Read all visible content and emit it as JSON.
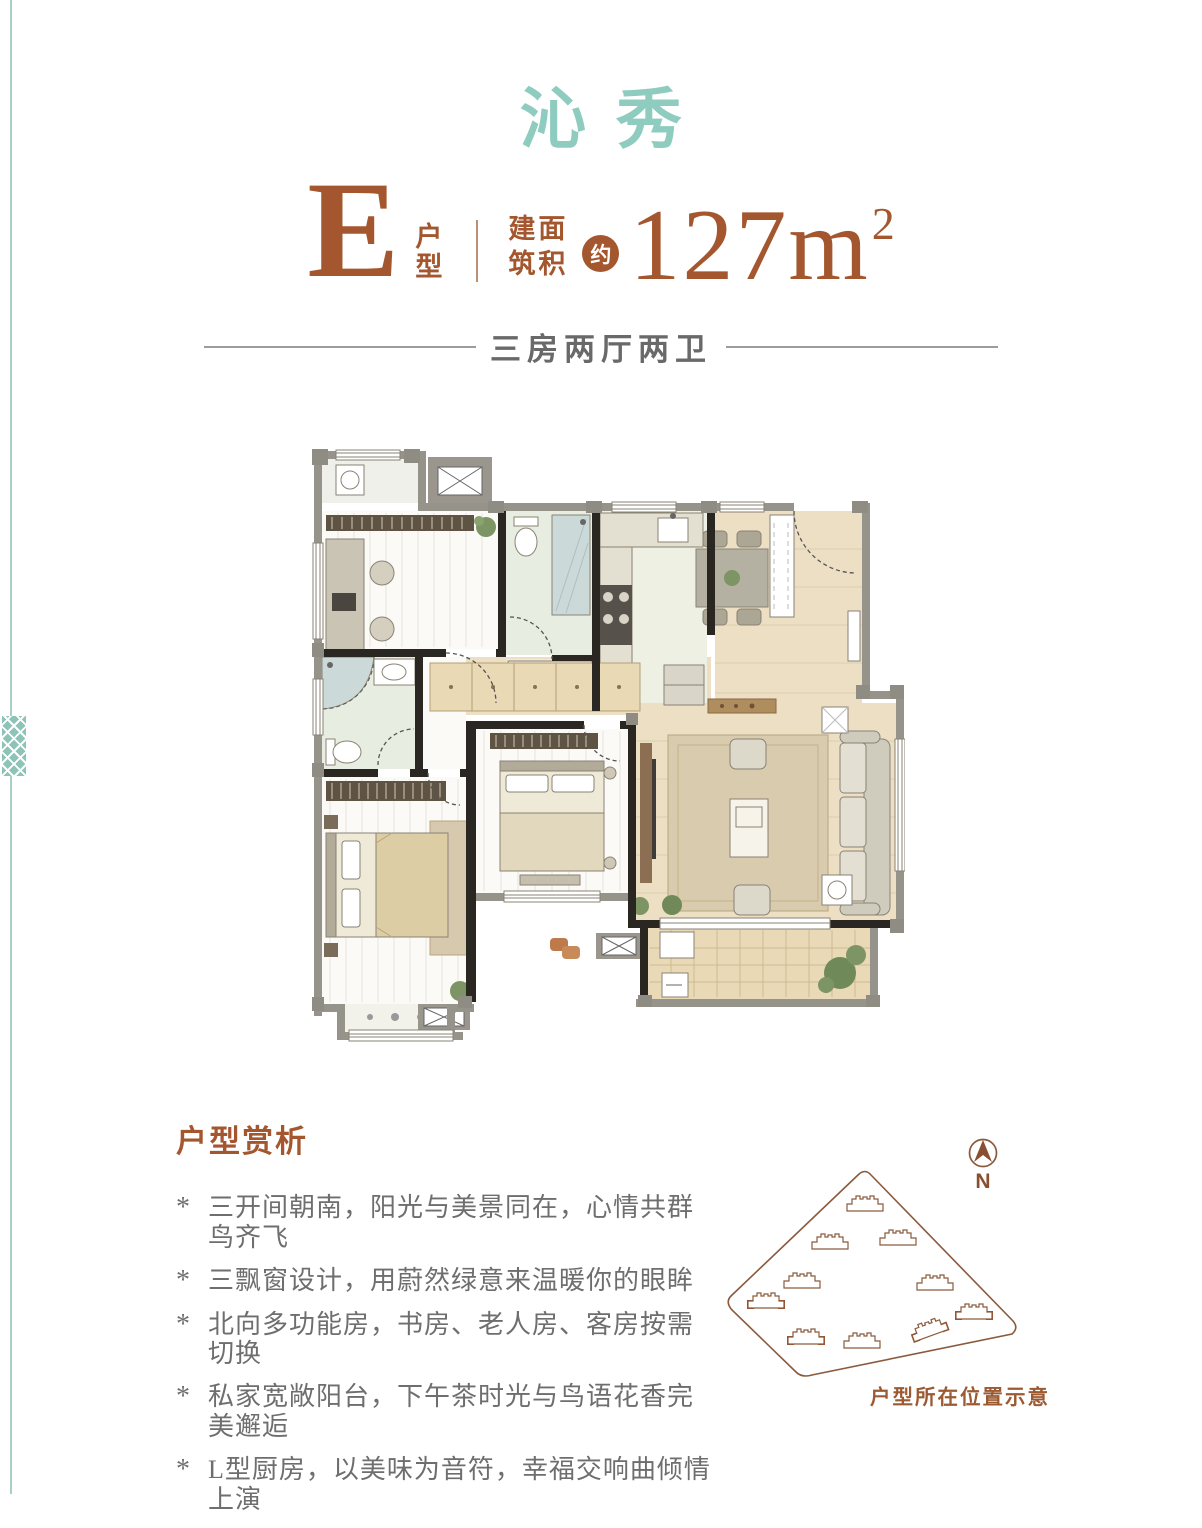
{
  "page": {
    "title": "沁秀"
  },
  "colors": {
    "teal_text": "#8fccc0",
    "teal_line": "#a9cfc7",
    "brown": "#a4572e",
    "text_gray": "#6e6e6e",
    "line_gray": "#9c9c9c",
    "site_brown": "#8a5a3c",
    "highlight": "#a34f28",
    "caption_brown": "#9c5a33"
  },
  "unit": {
    "letter": "E",
    "label_top": "户",
    "label_bottom": "型",
    "area_label_line1": "建面",
    "area_label_line2": "筑积",
    "approx_badge": "约",
    "area_value": "127",
    "area_unit_base": "m",
    "area_unit_sup": "2"
  },
  "subtitle": "三房两厅两卫",
  "analysis": {
    "heading": "户型赏析",
    "bullet_marker": "*",
    "bullets": [
      "三开间朝南，阳光与美景同在，心情共群鸟齐飞",
      "三飘窗设计，用蔚然绿意来温暖你的眼眸",
      "北向多功能房，书房、老人房、客房按需切换",
      "私家宽敞阳台，下午茶时光与鸟语花香完美邂逅",
      "L型厨房，以美味为音符，幸福交响曲倾情上演"
    ]
  },
  "site_plan": {
    "compass_label": "N",
    "caption": "户型所在位置示意",
    "buildings": [
      {
        "x": 145,
        "y": 74,
        "rot": 0,
        "highlighted": false
      },
      {
        "x": 110,
        "y": 112,
        "rot": 0,
        "highlighted": false
      },
      {
        "x": 178,
        "y": 108,
        "rot": 0,
        "highlighted": false
      },
      {
        "x": 82,
        "y": 151,
        "rot": 0,
        "highlighted": false
      },
      {
        "x": 215,
        "y": 153,
        "rot": 0,
        "highlighted": false
      },
      {
        "x": 46,
        "y": 171,
        "rot": 0,
        "highlighted": true
      },
      {
        "x": 254,
        "y": 182,
        "rot": 0,
        "highlighted": true
      },
      {
        "x": 86,
        "y": 207,
        "rot": 0,
        "highlighted": true
      },
      {
        "x": 142,
        "y": 211,
        "rot": 0,
        "highlighted": false
      },
      {
        "x": 209,
        "y": 199,
        "rot": -20,
        "highlighted": true
      }
    ]
  },
  "icons": {
    "compass-icon": "circle with north needle",
    "building-icon": "stepped building footprint outline",
    "ac-unit-icon": "white box with X",
    "plant-icon": "green circle cluster"
  }
}
